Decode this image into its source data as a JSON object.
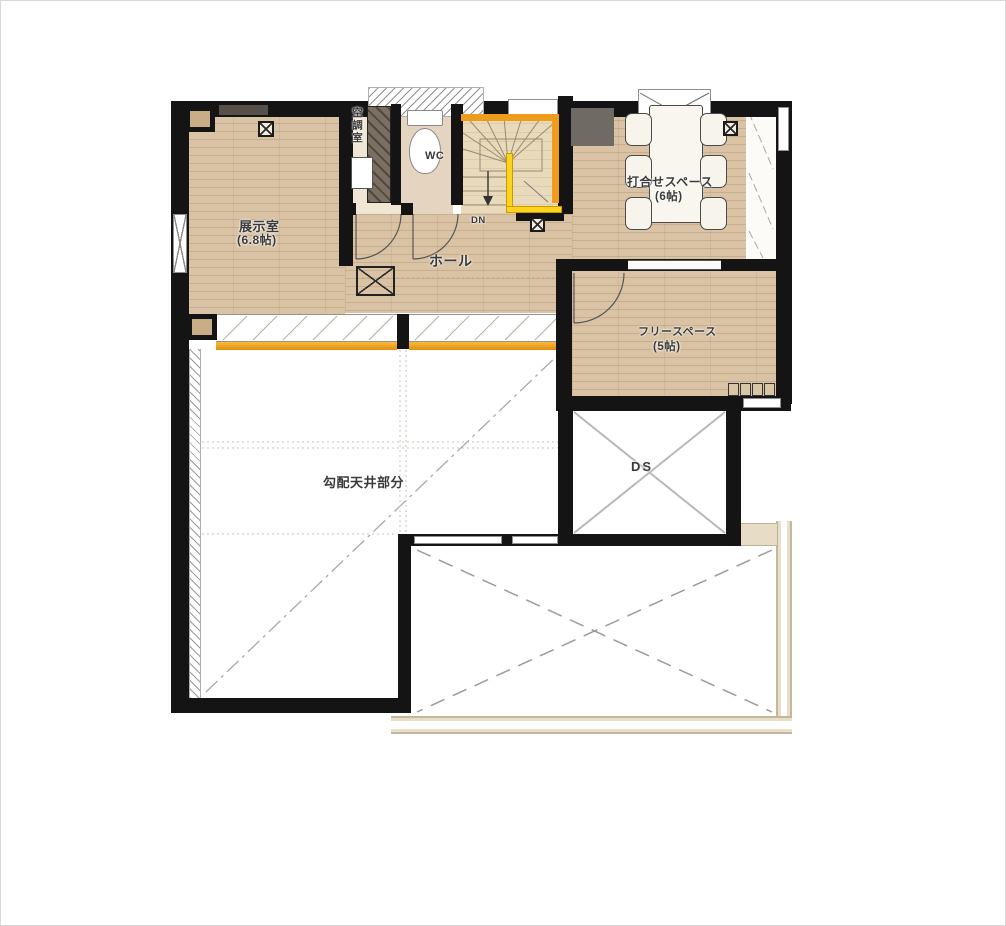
{
  "plan": {
    "rooms": {
      "exhibition": {
        "name": "展示室",
        "area": "(6.8帖)"
      },
      "air_conditioning": {
        "name": "空調室"
      },
      "toilet": {
        "name": "WC"
      },
      "stairs": {
        "direction": "DN"
      },
      "hall": {
        "name": "ホール"
      },
      "meeting_space": {
        "name": "打合せスペース",
        "area": "(6帖)"
      },
      "free_space": {
        "name": "フリースペース",
        "area": "(5帖)"
      },
      "duct_space": {
        "name": "DS"
      },
      "sloped_ceiling": {
        "name": "勾配天井部分"
      }
    },
    "colors": {
      "wall": "#141414",
      "wood_floor": "#d9c3a4",
      "stair_accent_orange": "#ef9b1c",
      "handrail_yellow": "#ffd21e",
      "window_sill_orange": "#efa61f",
      "railing_beige": "#e7ddc6",
      "label_text": "#3a3a3a"
    },
    "symbols": [
      "vent-symbol",
      "floor-hatch-symbol",
      "door-swing",
      "stair-fan",
      "duct-cross",
      "balcony-cross",
      "window-hatch"
    ]
  }
}
